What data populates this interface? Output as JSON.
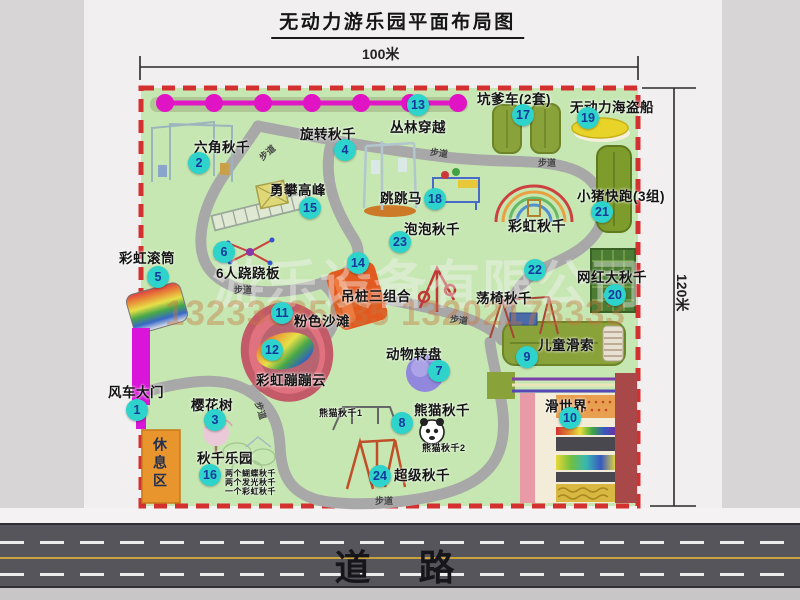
{
  "page": {
    "title": "无动力游乐园平面布局图"
  },
  "dimensions": {
    "top": "100米",
    "right": "120米"
  },
  "road": {
    "label": "道　路"
  },
  "watermark": {
    "company": "游乐设备有限公司",
    "phone": "13233835635 13202178333"
  },
  "colors": {
    "map_green": "#c6e7b2",
    "border_red": "#d43030",
    "badge_bg": "#2ed3cb",
    "badge_text": "#14399b",
    "path_gray": "#a8a8a8",
    "gate_magenta": "#d815d8",
    "rest_orange": "#e8952e",
    "road": "#55555b"
  },
  "map": {
    "rest_area_label": "休息区",
    "path_label_text": "步道",
    "attractions": [
      {
        "num": "1",
        "label": "风车大门",
        "bx": 137,
        "by": 410,
        "lx": 108,
        "ly": 381
      },
      {
        "num": "2",
        "label": "六角秋千",
        "bx": 199,
        "by": 163,
        "lx": 194,
        "ly": 136
      },
      {
        "num": "3",
        "label": "樱花树",
        "bx": 215,
        "by": 420,
        "lx": 191,
        "ly": 394
      },
      {
        "num": "4",
        "label": "旋转秋千",
        "bx": 345,
        "by": 150,
        "lx": 300,
        "ly": 123
      },
      {
        "num": "5",
        "label": "彩虹滚筒",
        "bx": 158,
        "by": 277,
        "lx": 119,
        "ly": 247
      },
      {
        "num": "6",
        "label": "6人跷跷板",
        "bx": 224,
        "by": 252,
        "lx": 216,
        "ly": 262
      },
      {
        "num": "7",
        "label": "动物转盘",
        "bx": 439,
        "by": 371,
        "lx": 386,
        "ly": 343
      },
      {
        "num": "8",
        "label": "熊猫秋千",
        "bx": 402,
        "by": 423,
        "lx": 414,
        "ly": 399
      },
      {
        "num": "9",
        "label": "儿童滑索",
        "bx": 527,
        "by": 357,
        "lx": 538,
        "ly": 334
      },
      {
        "num": "10",
        "label": "滑世界",
        "bx": 570,
        "by": 418,
        "lx": 545,
        "ly": 395
      },
      {
        "num": "11",
        "label": "粉色沙滩",
        "bx": 282,
        "by": 313,
        "lx": 294,
        "ly": 310
      },
      {
        "num": "12",
        "label": "彩虹蹦蹦云",
        "bx": 272,
        "by": 350,
        "lx": 256,
        "ly": 369
      },
      {
        "num": "13",
        "label": "丛林穿越",
        "bx": 418,
        "by": 105,
        "lx": 390,
        "ly": 116
      },
      {
        "num": "14",
        "label": "吊桩三组合",
        "bx": 358,
        "by": 263,
        "lx": 341,
        "ly": 285
      },
      {
        "num": "15",
        "label": "勇攀高峰",
        "bx": 310,
        "by": 208,
        "lx": 270,
        "ly": 179
      },
      {
        "num": "16",
        "label": "秋千乐园",
        "bx": 210,
        "by": 475,
        "lx": 197,
        "ly": 447
      },
      {
        "num": "17",
        "label": "坑爹车(2套)",
        "bx": 523,
        "by": 115,
        "lx": 477,
        "ly": 88
      },
      {
        "num": "18",
        "label": "跳跳马",
        "bx": 435,
        "by": 199,
        "lx": 380,
        "ly": 187
      },
      {
        "num": "19",
        "label": "无动力海盗船",
        "bx": 588,
        "by": 118,
        "lx": 570,
        "ly": 96
      },
      {
        "num": "20",
        "label": "网红大秋千",
        "bx": 615,
        "by": 295,
        "lx": 577,
        "ly": 266
      },
      {
        "num": "21",
        "label": "小猪快跑(3组)",
        "bx": 602,
        "by": 212,
        "lx": 577,
        "ly": 185
      },
      {
        "num": "22",
        "label": "荡椅秋千",
        "bx": 535,
        "by": 270,
        "lx": 476,
        "ly": 287
      },
      {
        "num": "23",
        "label": "泡泡秋千",
        "bx": 400,
        "by": 242,
        "lx": 404,
        "ly": 218
      },
      {
        "num": "24",
        "label": "超级秋千",
        "bx": 380,
        "by": 476,
        "lx": 394,
        "ly": 464
      }
    ],
    "extra_labels": [
      {
        "text": "彩虹秋千",
        "x": 508,
        "y": 216,
        "size": 14
      },
      {
        "text": "熊猫秋千1",
        "x": 319,
        "y": 406,
        "size": 9
      },
      {
        "text": "熊猫秋千2",
        "x": 422,
        "y": 441,
        "size": 9
      },
      {
        "text": "两个蝴蝶秋千",
        "x": 225,
        "y": 468,
        "size": 8
      },
      {
        "text": "两个发光秋千",
        "x": 225,
        "y": 477,
        "size": 8
      },
      {
        "text": "一个彩虹秋千",
        "x": 225,
        "y": 486,
        "size": 8
      }
    ],
    "path_labels": [
      {
        "x": 258,
        "y": 146,
        "rot": -40
      },
      {
        "x": 430,
        "y": 146,
        "rot": 8
      },
      {
        "x": 538,
        "y": 156,
        "rot": 0
      },
      {
        "x": 234,
        "y": 283,
        "rot": 0
      },
      {
        "x": 450,
        "y": 313,
        "rot": 8
      },
      {
        "x": 252,
        "y": 404,
        "rot": 72
      },
      {
        "x": 375,
        "y": 494,
        "rot": 0
      }
    ]
  }
}
